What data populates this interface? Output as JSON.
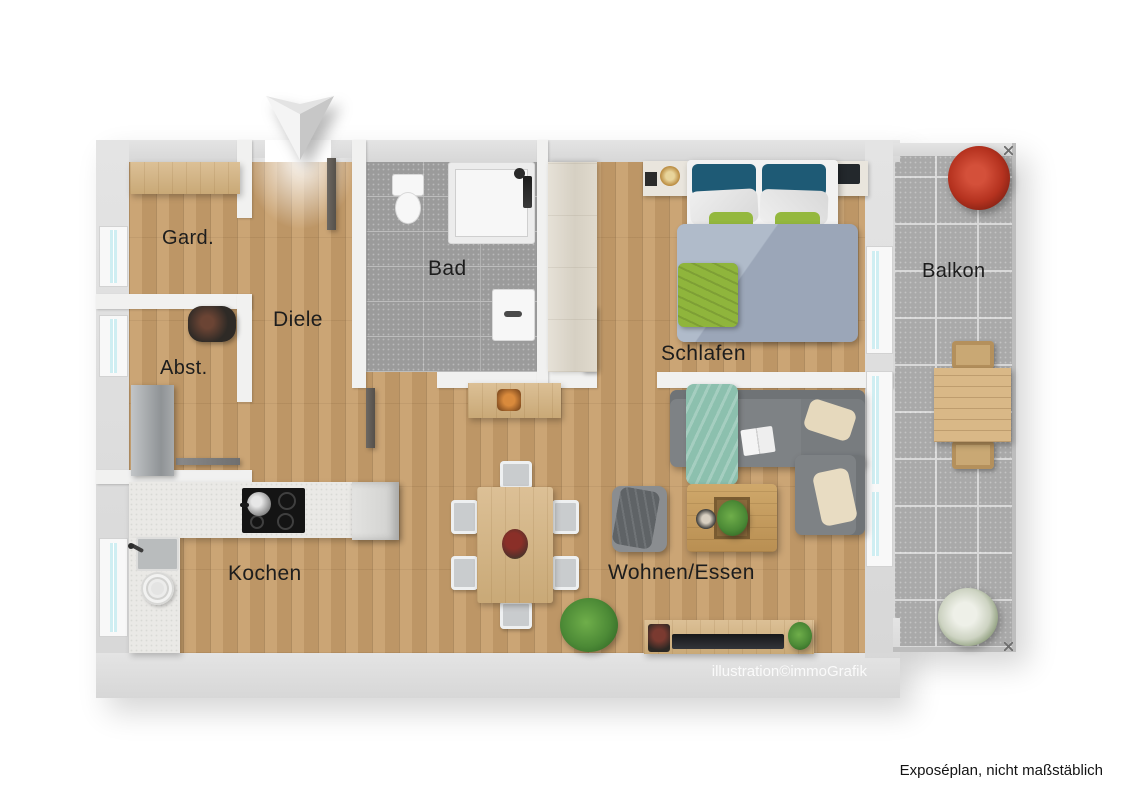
{
  "plan": {
    "rooms": [
      {
        "id": "gard",
        "label": "Gard."
      },
      {
        "id": "abst",
        "label": "Abst."
      },
      {
        "id": "diele",
        "label": "Diele"
      },
      {
        "id": "bad",
        "label": "Bad"
      },
      {
        "id": "schlafen",
        "label": "Schlafen"
      },
      {
        "id": "kochen",
        "label": "Kochen"
      },
      {
        "id": "wohnen",
        "label": "Wohnen/Essen"
      },
      {
        "id": "balkon",
        "label": "Balkon"
      }
    ],
    "credit": "illustration©immoGrafik",
    "north_arrow_icon": "north-arrow"
  },
  "footer": {
    "note": "Exposéplan, nicht maßstäblich"
  },
  "colors": {
    "wall": "#dcdcdc",
    "inner_wall": "#f1f1f0",
    "wood_floor": "#c79e6b",
    "bathroom_tile": "#9b9b9b",
    "balcony_tile": "#a9a9a9",
    "window_glass": "#cfeef2",
    "pillow_blue": "#1e5a75",
    "accent_green": "#94b83e",
    "duvet_gray_blue": "#9ba6b8",
    "sofa_gray": "#7e8285",
    "blanket_teal": "#8cc0ae",
    "plant_red": "#b5321f"
  }
}
